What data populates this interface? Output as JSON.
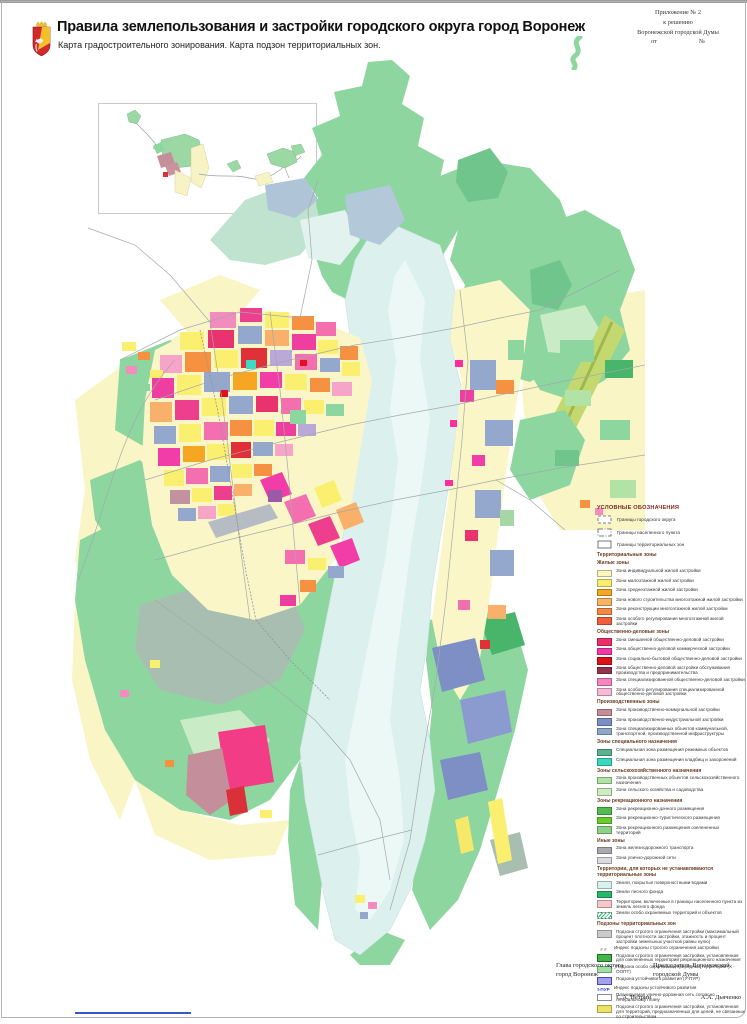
{
  "header": {
    "title": "Правила землепользования и застройки городского округа город Воронеж",
    "subtitle": "Карта градостроительного зонирования. Карта подзон территориальных зон.",
    "annex": {
      "line1": "Приложение № 2",
      "line2": "к решению",
      "line3": "Воронежской городской Думы",
      "from_label": "от",
      "number_label": "№"
    },
    "emblem_icon": "voronezh-coat-of-arms"
  },
  "legend": {
    "title": "УСЛОВНЫЕ ОБОЗНАЧЕНИЯ",
    "boundaries": [
      {
        "dash": "3,2",
        "label": "Границы городского округа"
      },
      {
        "dash": "5,1.5,1,1.5",
        "label": "Границы населенного пункта"
      },
      {
        "dash": "",
        "label": "Границы территориальных зон"
      }
    ],
    "sections": [
      {
        "header": "Территориальные зоны",
        "items": []
      },
      {
        "header": "Жилые зоны",
        "items": [
          {
            "color": "#FCF6BE",
            "label": "Зона индивидуальной жилой застройки"
          },
          {
            "color": "#FAEC6E",
            "label": "Зона малоэтажной жилой застройки"
          },
          {
            "color": "#F5A71F",
            "label": "Зона среднеэтажной жилой застройки"
          },
          {
            "color": "#F8B264",
            "label": "Зона нового строительства многоэтажной жилой застройки"
          },
          {
            "color": "#F48A42",
            "label": "Зона реконструкции многоэтажной жилой застройки"
          },
          {
            "color": "#F0603C",
            "label": "Зона особого регулирования многоэтажной жилой застройки"
          }
        ]
      },
      {
        "header": "Общественно-деловые зоны",
        "items": [
          {
            "color": "#ED2E67",
            "label": "Зона смешанной общественно-деловой застройки"
          },
          {
            "color": "#F13AA5",
            "label": "Зона общественно-деловой коммерческой застройки"
          },
          {
            "color": "#DC1216",
            "label": "Зона социально-бытовой общественно-деловой застройки"
          },
          {
            "color": "#91344E",
            "label": "Зона общественно-деловой застройки обслуживания производства и предпринимательства"
          },
          {
            "color": "#F684BF",
            "label": "Зона специализированной общественно-деловой застройки"
          },
          {
            "color": "#F8B9D7",
            "label": "Зона особого регулирования специализированной общественно-деловой застройки"
          }
        ]
      },
      {
        "header": "Производственные зоны",
        "items": [
          {
            "color": "#C78D97",
            "label": "Зона производственно-коммунальной застройки"
          },
          {
            "color": "#7C8EC6",
            "label": "Зона производственно-индустриальной застройки"
          },
          {
            "color": "#8EA8CA",
            "label": "Зона специализированных объектов коммунальной, транспортной, производственной инфраструктуры"
          }
        ]
      },
      {
        "header": "Зоны специального назначения",
        "items": [
          {
            "color": "#59B291",
            "label": "Специальная зона размещения режимных объектов"
          },
          {
            "color": "#3BD8C1",
            "label": "Специальная зона размещения кладбищ и захоронений"
          }
        ]
      },
      {
        "header": "Зоны сельскохозяйственного назначения",
        "items": [
          {
            "color": "#AFE2A3",
            "label": "Зона производственных объектов сельскохозяйственного назначения"
          },
          {
            "color": "#CDEDC0",
            "label": "Зона сельского хозяйства и садоводства"
          }
        ]
      },
      {
        "header": "Зоны рекреационного назначения",
        "items": [
          {
            "color": "#52BC52",
            "label": "Зона рекреационно-дачного размещения"
          },
          {
            "color": "#6CCB2C",
            "label": "Зона рекреационно-туристического размещения"
          },
          {
            "color": "#8CD387",
            "label": "Зона рекреационного размещения озелененных территорий"
          }
        ]
      },
      {
        "header": "Иные зоны",
        "items": [
          {
            "color": "#A9A9B1",
            "label": "Зона железнодорожного транспорта"
          },
          {
            "color": "#DADAE0",
            "label": "Зона улично-дорожной сети"
          }
        ]
      },
      {
        "header": "Территории, для которых не устанавливаются территориальные зоны",
        "items": [
          {
            "color": "#D7F2ED",
            "label": "Земли, покрытые поверхностными водами"
          },
          {
            "color": "#27B768",
            "label": "Земли лесного фонда"
          },
          {
            "color": "#F5C8CA",
            "label": "Территории, включенные в границы населенного пункта из земель лесного фонда"
          },
          {
            "type": "hatch",
            "label": "Земли особо охраняемых территорий и объектов"
          }
        ]
      },
      {
        "header": "Подзоны территориальных зон",
        "items": [
          {
            "color": "#CBCBCB",
            "label": "Подзона строгого ограничения застройки (максимальный процент плотности застройки, этажность и процент застройки земельных участков равны нулю)"
          },
          {
            "type": "index",
            "index": "# #",
            "index_color": "#888888",
            "label": "Индекс подзоны строгого ограничения застройки"
          },
          {
            "color": "#44B54A",
            "border": "#1C6E22",
            "label": "Подзона строгого ограничения застройки, установленная для озелененных территорий рекреационного назначения"
          },
          {
            "color": "#9EDFA3",
            "label": "Подзона особо охраняемых природных территорий (Х - ООПТ)"
          },
          {
            "color": "#A0A0EC",
            "border": "#4848B0",
            "label": "Подзона устойчивого развития (У-ПУР)"
          },
          {
            "type": "index",
            "index": "t-ПУР",
            "index_color": "#2A46C8",
            "label": "Индекс подзоны устойчивого развития"
          },
          {
            "color": "#FFFFFF",
            "border": "#8A8A8A",
            "label": "Планируемая улично-дорожная сеть согласно генеральному плану"
          },
          {
            "color": "#EEE266",
            "label": "Подзона строгого ограничения застройки, установленная для территорий, предназначенных для целей, не связанных со строительством"
          }
        ]
      }
    ]
  },
  "footer": {
    "left_title": "Глава городского округа\nгород Воронеж",
    "left_name": "С.А. Петрин",
    "right_title": "Председатель Воронежской\nгородской Думы",
    "right_name": "А.А. Дьяченко"
  }
}
